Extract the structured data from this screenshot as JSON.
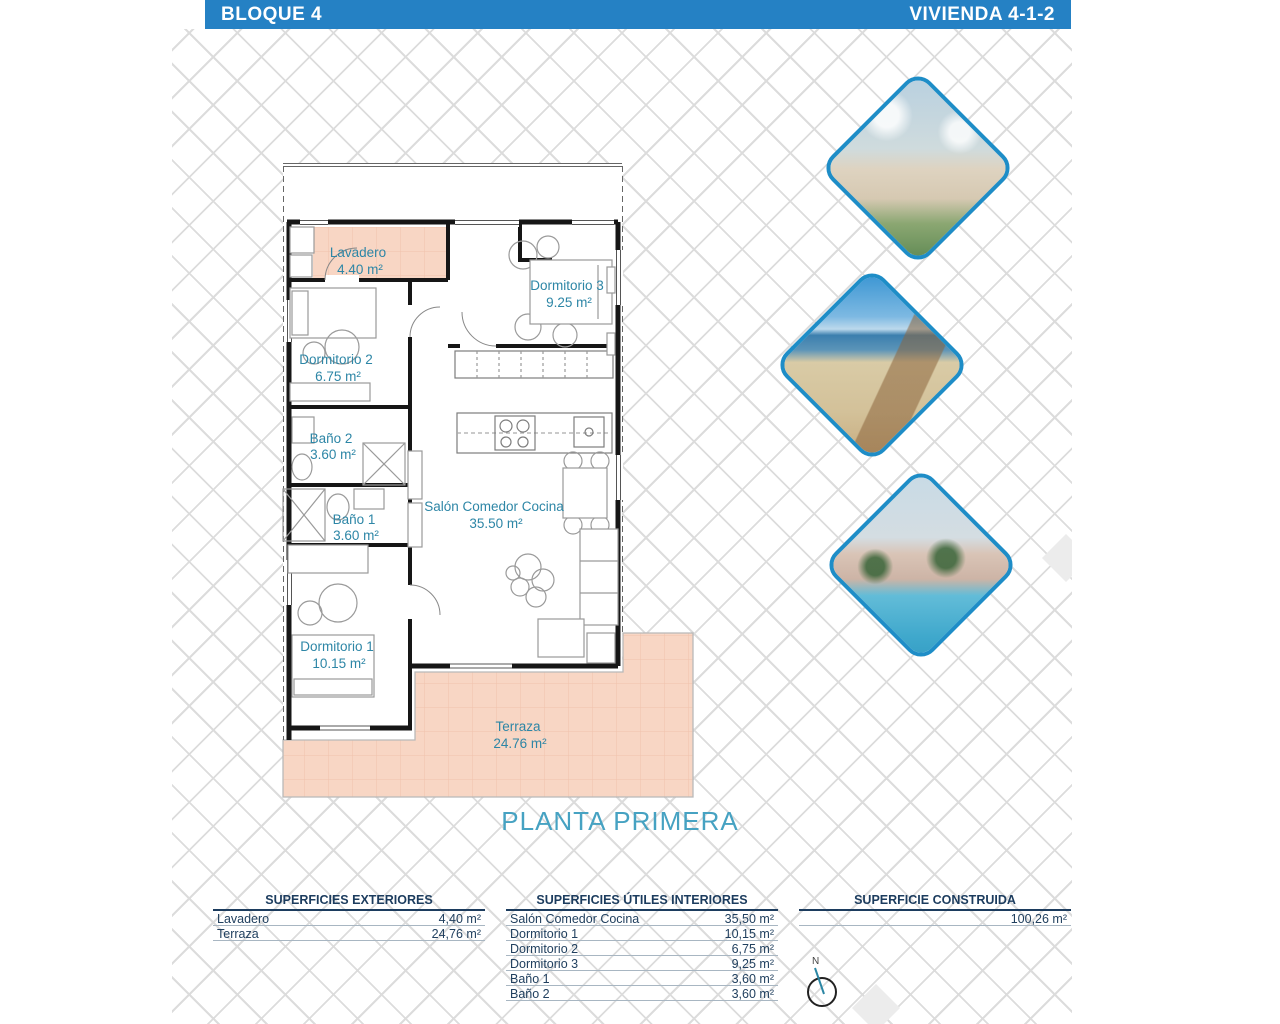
{
  "header": {
    "block": "BLOQUE 4",
    "unit": "VIVIENDA 4-1-2"
  },
  "plan": {
    "floor_label": "PLANTA PRIMERA",
    "compass_label": "N",
    "rooms": [
      {
        "name": "Lavadero",
        "area": "4.40 m²"
      },
      {
        "name": "Dormitorio 3",
        "area": "9.25 m²"
      },
      {
        "name": "Dormitorio 2",
        "area": "6.75 m²"
      },
      {
        "name": "Baño 2",
        "area": "3.60 m²"
      },
      {
        "name": "Baño 1",
        "area": "3.60 m²"
      },
      {
        "name": "Salón Comedor Cocina",
        "area": "35.50 m²"
      },
      {
        "name": "Dormitorio 1",
        "area": "10.15 m²"
      },
      {
        "name": "Terraza",
        "area": "24.76 m²"
      }
    ]
  },
  "photos": [
    {
      "name": "apartment-complex-render"
    },
    {
      "name": "beach-boardwalk-photo"
    },
    {
      "name": "pool-area-render"
    }
  ],
  "tables": {
    "exteriores": {
      "title": "SUPERFICIES EXTERIORES",
      "rows": [
        {
          "label": "Lavadero",
          "value": "4,40 m²"
        },
        {
          "label": "Terraza",
          "value": "24,76 m²"
        }
      ]
    },
    "interiores": {
      "title": "SUPERFICIES ÚTILES INTERIORES",
      "rows": [
        {
          "label": "Salón Comedor Cocina",
          "value": "35,50 m²"
        },
        {
          "label": "Dormitorio 1",
          "value": "10,15 m²"
        },
        {
          "label": "Dormitorio 2",
          "value": "6,75 m²"
        },
        {
          "label": "Dormitorio 3",
          "value": "9,25 m²"
        },
        {
          "label": "Baño 1",
          "value": "3,60 m²"
        },
        {
          "label": "Baño 2",
          "value": "3,60 m²"
        }
      ]
    },
    "construida": {
      "title": "SUPERFICIE CONSTRUIDA",
      "rows": [
        {
          "label": "",
          "value": "100,26 m²"
        }
      ]
    }
  },
  "colors": {
    "header_blue": "#2581c4",
    "room_label_teal": "#2d86a6",
    "floor_label_teal": "#46a2c2",
    "terrace_peach": "#f8d6c4",
    "table_navy": "#1c3c5e",
    "diamond_border_blue": "#1e8dc7"
  }
}
